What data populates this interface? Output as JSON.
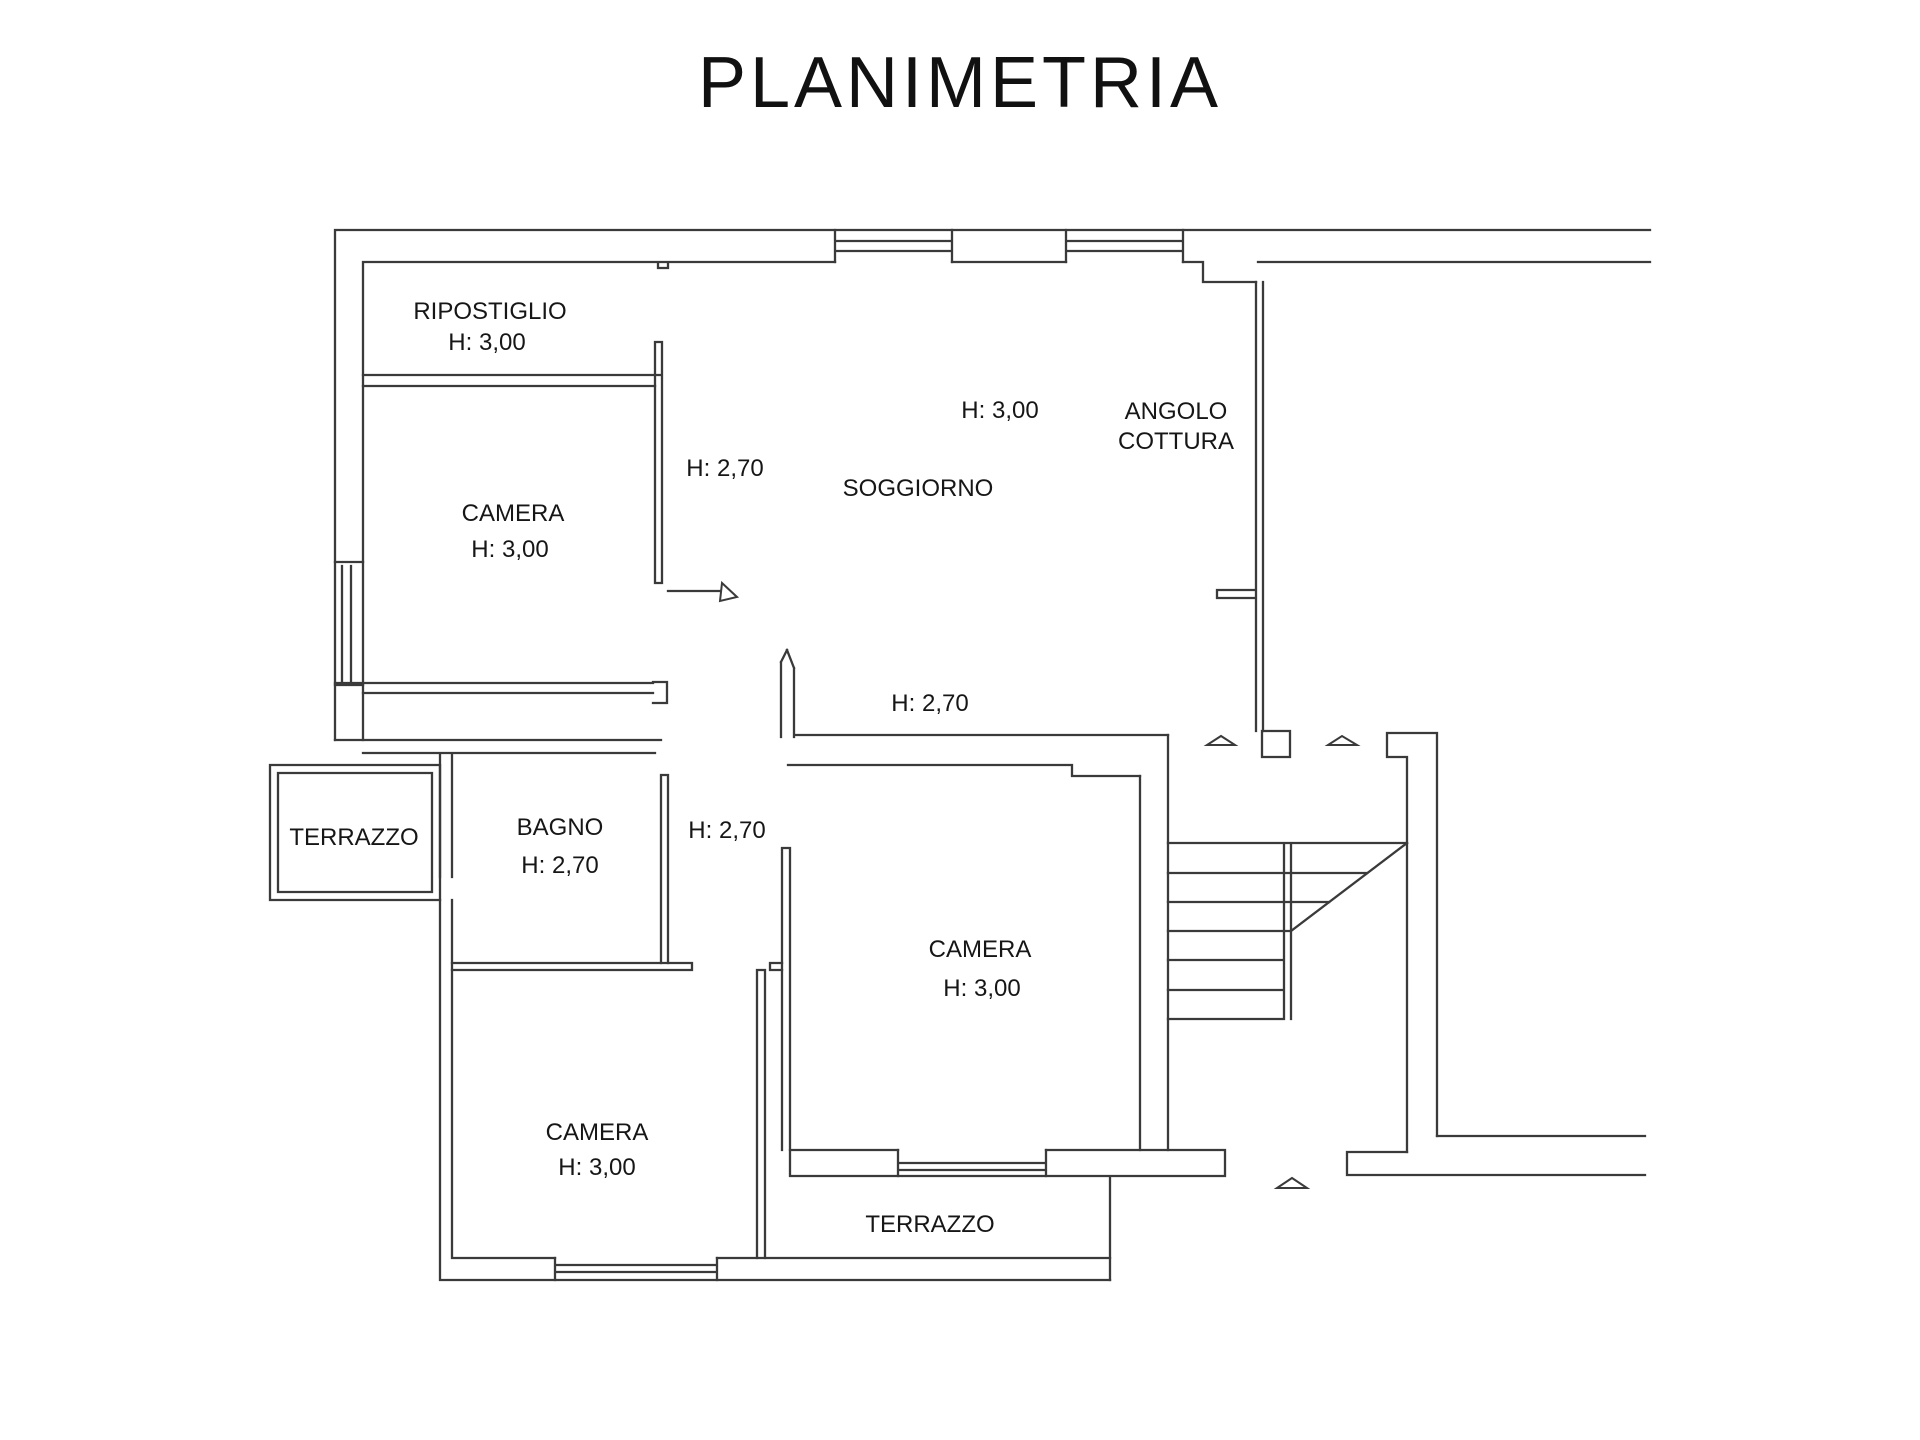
{
  "title": "PLANIMETRIA",
  "plan": {
    "background": "#ffffff",
    "line_color": "#3a3a3a",
    "rooms": [
      {
        "name": "ripostiglio",
        "label": "RIPOSTIGLIO",
        "height": "H: 3,00"
      },
      {
        "name": "camera-nord-ovest",
        "label": "CAMERA",
        "height": "H: 3,00"
      },
      {
        "name": "soggiorno",
        "label": "SOGGIORNO",
        "height": "H: 3,00"
      },
      {
        "name": "angolo-cottura",
        "label": "ANGOLO COTTURA",
        "height": ""
      },
      {
        "name": "bagno",
        "label": "BAGNO",
        "height": "H: 2,70"
      },
      {
        "name": "terrazzo-ovest",
        "label": "TERRAZZO",
        "height": ""
      },
      {
        "name": "camera-centrale",
        "label": "CAMERA",
        "height": "H: 3,00"
      },
      {
        "name": "camera-sud-ovest",
        "label": "CAMERA",
        "height": "H: 3,00"
      },
      {
        "name": "terrazzo-sud",
        "label": "TERRAZZO",
        "height": ""
      }
    ],
    "labels": [
      {
        "name": "ripostiglio",
        "text": "RIPOSTIGLIO",
        "x": 490,
        "y": 319
      },
      {
        "name": "ripostiglio-height",
        "text": "H: 3,00",
        "x": 487,
        "y": 350
      },
      {
        "name": "camera-nw",
        "text": "CAMERA",
        "x": 513,
        "y": 521
      },
      {
        "name": "camera-nw-height",
        "text": "H: 3,00",
        "x": 510,
        "y": 557
      },
      {
        "name": "divider-height",
        "text": "H: 2,70",
        "x": 725,
        "y": 476
      },
      {
        "name": "soggiorno-height",
        "text": "H: 3,00",
        "x": 1000,
        "y": 418
      },
      {
        "name": "soggiorno",
        "text": "SOGGIORNO",
        "x": 918,
        "y": 496
      },
      {
        "name": "angolo-line1",
        "text": "ANGOLO",
        "x": 1176,
        "y": 419
      },
      {
        "name": "angolo-line2",
        "text": "COTTURA",
        "x": 1176,
        "y": 449
      },
      {
        "name": "hall-height",
        "text": "H: 2,70",
        "x": 930,
        "y": 711
      },
      {
        "name": "terrazzo-ovest",
        "text": "TERRAZZO",
        "x": 354,
        "y": 845
      },
      {
        "name": "bagno",
        "text": "BAGNO",
        "x": 560,
        "y": 835
      },
      {
        "name": "bagno-height",
        "text": "H: 2,70",
        "x": 560,
        "y": 873
      },
      {
        "name": "corridor-height",
        "text": "H: 2,70",
        "x": 727,
        "y": 838
      },
      {
        "name": "camera-centro",
        "text": "CAMERA",
        "x": 980,
        "y": 957
      },
      {
        "name": "camera-centro-height",
        "text": "H: 3,00",
        "x": 982,
        "y": 996
      },
      {
        "name": "camera-sw",
        "text": "CAMERA",
        "x": 597,
        "y": 1140
      },
      {
        "name": "camera-sw-height",
        "text": "H: 3,00",
        "x": 597,
        "y": 1175
      },
      {
        "name": "terrazzo-sud",
        "text": "TERRAZZO",
        "x": 930,
        "y": 1232
      }
    ]
  }
}
